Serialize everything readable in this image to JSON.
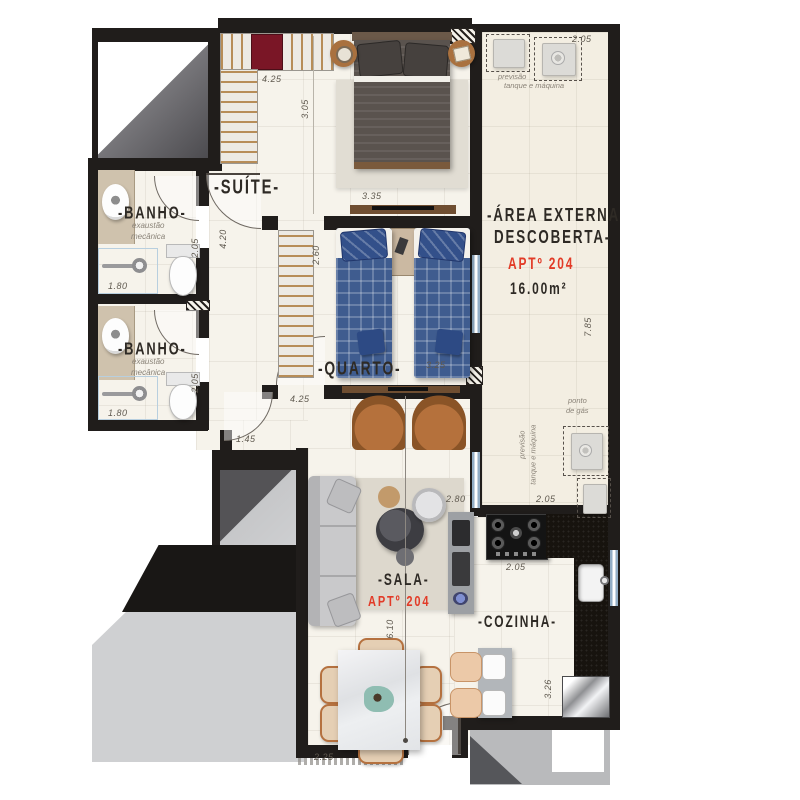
{
  "plan_title": "Planta APTº 204",
  "colors": {
    "wall": "#201d1b",
    "floor": "#f6f3eb",
    "floor_externa": "#f3eee2",
    "accent_red": "#e23b27",
    "text_dark": "#2e2a25",
    "text_dim": "#5f594f",
    "outside_gray": "#cfd0d2",
    "window_blue": "#93aec6"
  },
  "rooms": {
    "suite": {
      "label": "-SUÍTE-"
    },
    "banho1": {
      "label": "-BANHO-",
      "note1": "exaustão",
      "note2": "mecânica"
    },
    "banho2": {
      "label": "-BANHO-",
      "note1": "exaustão",
      "note2": "mecânica"
    },
    "quarto": {
      "label": "-QUARTO-"
    },
    "area_externa": {
      "label1": "-ÁREA EXTERNA",
      "label2": "DESCOBERTA-",
      "apt": "APTº 204",
      "area": "16.00m²"
    },
    "sala": {
      "label": "-SALA-",
      "apt": "APTº 204"
    },
    "cozinha": {
      "label": "-COZINHA-"
    }
  },
  "annotations": {
    "previsao_top_1": "previsão",
    "previsao_top_2": "tanque e máquina",
    "ponto_gas_1": "ponto",
    "ponto_gas_2": "de gás",
    "previsao_right_1": "previsão",
    "previsao_right_2": "tanque e máquina"
  },
  "dims": {
    "suite_closet": "4.25",
    "suite_depth": "3.05",
    "suite_bed": "3.35",
    "banho1_h": "2.05",
    "banho1_w": "1.80",
    "banho2_h": "2.05",
    "banho2_w": "1.80",
    "hall_h": "4.20",
    "quarto_closet": "2.60",
    "quarto_w": "3.25",
    "quarto_w2": "4.25",
    "hall_w": "1.45",
    "externa_top": "2.05",
    "externa_len": "7.85",
    "externa_bottom": "2.05",
    "cooktop_w": "2.05",
    "sala_w": "2.80",
    "sala_len": "6.10",
    "dining_w": "2.25",
    "cozinha_len": "3.26"
  }
}
